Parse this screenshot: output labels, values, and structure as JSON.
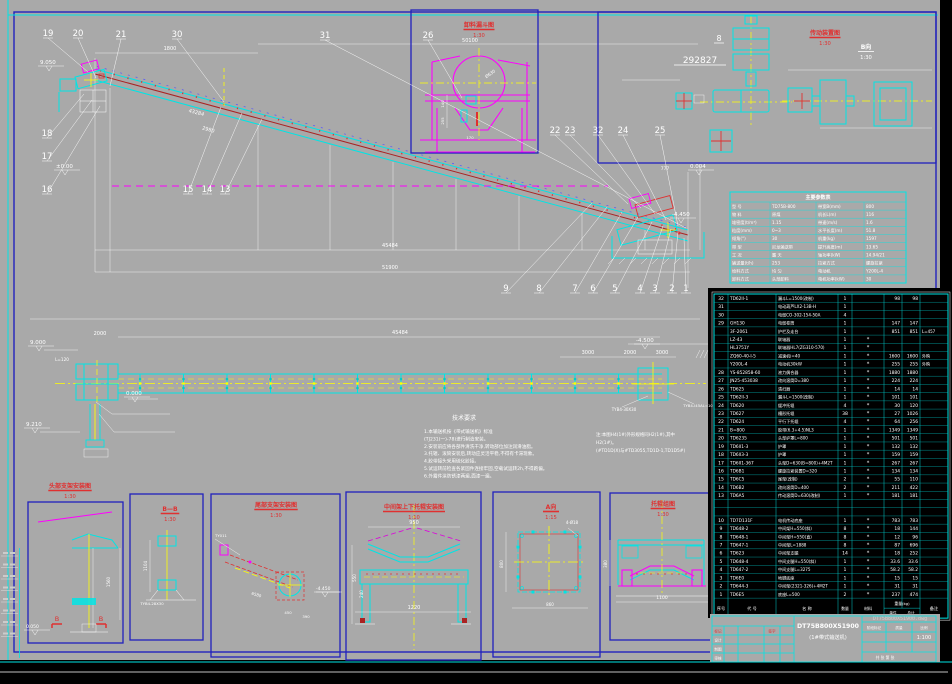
{
  "drawing": {
    "title": "DT75B800X51900",
    "subtitle": "(1#带式输送机)",
    "scale": "1:100",
    "watermark": "DT75B800X51900.dwg",
    "sheet_note": "共 张 第 张",
    "stage_labels": [
      "阶段标记",
      "质量",
      "比例"
    ],
    "revision_header": [
      "标记",
      "签字"
    ],
    "revision_rows": [
      "设计",
      "制图",
      "审核"
    ]
  },
  "colors": {
    "paper": "#a9a9a9",
    "frame": "#2121bd",
    "cyan": "#00e5e5",
    "magenta": "#ff00ff",
    "yellow": "#ffff00",
    "red": "#e03030",
    "dark_red": "#aa2222",
    "white": "#ffffff",
    "black": "#000000"
  },
  "view_titles": [
    {
      "label": "卸料漏斗图",
      "scale": "1:30",
      "x": 479,
      "y": 27,
      "color": "red"
    },
    {
      "label": "传动装置图",
      "scale": "1:30",
      "x": 825,
      "y": 35,
      "color": "red"
    },
    {
      "label": "B向",
      "scale": "1:30",
      "x": 866,
      "y": 49,
      "color": "white"
    },
    {
      "label": "头部支架安装图",
      "scale": "1:30",
      "x": 70,
      "y": 488,
      "color": "red"
    },
    {
      "label": "B—B",
      "scale": "1:30",
      "x": 170,
      "y": 511,
      "color": "red"
    },
    {
      "label": "尾部支架安装图",
      "scale": "1:30",
      "x": 276,
      "y": 507,
      "color": "red"
    },
    {
      "label": "中间架上下托辊安装图",
      "scale": "1:10",
      "x": 414,
      "y": 509,
      "color": "red"
    },
    {
      "label": "A向",
      "scale": "1:15",
      "x": 551,
      "y": 509,
      "color": "red"
    },
    {
      "label": "托辊组图",
      "scale": "1:30",
      "x": 663,
      "y": 506,
      "color": "red"
    }
  ],
  "balloons": [
    {
      "n": "19",
      "x": 48,
      "y": 36,
      "lx": 88,
      "ly": 72
    },
    {
      "n": "20",
      "x": 78,
      "y": 36,
      "lx": 96,
      "ly": 78
    },
    {
      "n": "21",
      "x": 121,
      "y": 37,
      "lx": 110,
      "ly": 86
    },
    {
      "n": "30",
      "x": 177,
      "y": 37,
      "lx": 224,
      "ly": 102
    },
    {
      "n": "31",
      "x": 325,
      "y": 38,
      "lx": 686,
      "ly": 228
    },
    {
      "n": "26",
      "x": 428,
      "y": 38,
      "lx": 462,
      "ly": 98
    },
    {
      "n": "22",
      "x": 555,
      "y": 133,
      "lx": 628,
      "ly": 204
    },
    {
      "n": "23",
      "x": 570,
      "y": 133,
      "lx": 641,
      "ly": 208
    },
    {
      "n": "32",
      "x": 598,
      "y": 133,
      "lx": 655,
      "ly": 214
    },
    {
      "n": "24",
      "x": 623,
      "y": 133,
      "lx": 666,
      "ly": 220
    },
    {
      "n": "25",
      "x": 660,
      "y": 133,
      "lx": 678,
      "ly": 226
    },
    {
      "n": "18",
      "x": 47,
      "y": 136,
      "lx": 84,
      "ly": 94
    },
    {
      "n": "17",
      "x": 47,
      "y": 159,
      "lx": 92,
      "ly": 100
    },
    {
      "n": "16",
      "x": 47,
      "y": 192,
      "lx": 100,
      "ly": 106
    },
    {
      "n": "15",
      "x": 188,
      "y": 192,
      "lx": 221,
      "ly": 107
    },
    {
      "n": "14",
      "x": 207,
      "y": 192,
      "lx": 242,
      "ly": 113
    },
    {
      "n": "13",
      "x": 225,
      "y": 192,
      "lx": 262,
      "ly": 119
    },
    {
      "n": "9",
      "x": 506,
      "y": 291,
      "lx": 592,
      "ly": 203
    },
    {
      "n": "8",
      "x": 539,
      "y": 291,
      "lx": 607,
      "ly": 207
    },
    {
      "n": "7",
      "x": 575,
      "y": 291,
      "lx": 622,
      "ly": 212
    },
    {
      "n": "6",
      "x": 593,
      "y": 291,
      "lx": 638,
      "ly": 217
    },
    {
      "n": "5",
      "x": 615,
      "y": 291,
      "lx": 652,
      "ly": 222
    },
    {
      "n": "4",
      "x": 640,
      "y": 291,
      "lx": 663,
      "ly": 226
    },
    {
      "n": "3",
      "x": 655,
      "y": 291,
      "lx": 671,
      "ly": 229
    },
    {
      "n": "2",
      "x": 672,
      "y": 291,
      "lx": 678,
      "ly": 232
    },
    {
      "n": "1",
      "x": 686,
      "y": 291,
      "lx": 684,
      "ly": 238
    }
  ],
  "elevations": [
    {
      "v": "9.050",
      "x": 40,
      "y": 64
    },
    {
      "v": "±0.00",
      "x": 56,
      "y": 168
    },
    {
      "v": "0.004",
      "x": 690,
      "y": 168
    },
    {
      "v": "-4.450",
      "x": 672,
      "y": 216
    },
    {
      "v": "9.000",
      "x": 30,
      "y": 344
    },
    {
      "v": "9.210",
      "x": 26,
      "y": 426
    },
    {
      "v": "0.000",
      "x": 126,
      "y": 395
    },
    {
      "v": "-4.500",
      "x": 636,
      "y": 342
    },
    {
      "v": "0.050",
      "x": 26,
      "y": 628,
      "s": 4.5
    },
    {
      "v": "-4.450",
      "x": 316,
      "y": 590,
      "s": 4.5
    }
  ],
  "dimensions": [
    {
      "v": "1800",
      "x": 170,
      "y": 50
    },
    {
      "v": "50100",
      "x": 470,
      "y": 42
    },
    {
      "v": "43284",
      "x": 196,
      "y": 114,
      "rot": 15
    },
    {
      "v": "2980",
      "x": 208,
      "y": 131,
      "rot": 15
    },
    {
      "v": "45484",
      "x": 390,
      "y": 247
    },
    {
      "v": "51900",
      "x": 390,
      "y": 269
    },
    {
      "v": "777",
      "x": 665,
      "y": 170,
      "s": 4.5
    },
    {
      "v": "45484",
      "x": 400,
      "y": 334
    },
    {
      "v": "2000",
      "x": 100,
      "y": 335
    },
    {
      "v": "3000",
      "x": 588,
      "y": 354
    },
    {
      "v": "2000",
      "x": 630,
      "y": 354
    },
    {
      "v": "3000",
      "x": 662,
      "y": 354
    },
    {
      "v": "1220",
      "x": 414,
      "y": 609
    },
    {
      "v": "950",
      "x": 414,
      "y": 524
    },
    {
      "v": "550",
      "x": 356,
      "y": 578,
      "rot": -90,
      "s": 4
    },
    {
      "v": "240",
      "x": 363,
      "y": 594,
      "rot": -90,
      "s": 4
    },
    {
      "v": "1560",
      "x": 110,
      "y": 582,
      "rot": -90,
      "s": 4
    },
    {
      "v": "1104",
      "x": 147,
      "y": 566,
      "rot": -90,
      "s": 4
    },
    {
      "v": "6580",
      "x": 256,
      "y": 596,
      "rot": 17,
      "s": 4
    },
    {
      "v": "450",
      "x": 288,
      "y": 614,
      "s": 3.8
    },
    {
      "v": "390",
      "x": 306,
      "y": 618,
      "s": 3.8
    },
    {
      "v": "860",
      "x": 550,
      "y": 606,
      "s": 4
    },
    {
      "v": "800",
      "x": 503,
      "y": 564,
      "rot": -90,
      "s": 4
    },
    {
      "v": "1100",
      "x": 662,
      "y": 599,
      "s": 4.5
    },
    {
      "v": "380",
      "x": 607,
      "y": 564,
      "rot": -90,
      "s": 4
    },
    {
      "v": "170",
      "x": 470,
      "y": 139,
      "s": 3.8
    },
    {
      "v": "140",
      "x": 444,
      "y": 104,
      "rot": -90,
      "s": 3.8
    },
    {
      "v": "255",
      "x": 444,
      "y": 121,
      "rot": -90,
      "s": 3.8
    },
    {
      "v": "Ø630",
      "x": 491,
      "y": 75,
      "rot": -35,
      "s": 4.2
    },
    {
      "v": "4-Ø18",
      "x": 572,
      "y": 524,
      "s": 4
    }
  ],
  "labels": [
    {
      "v": "292827",
      "x": 700,
      "y": 63,
      "s": 9,
      "u": 26
    },
    {
      "v": "8",
      "x": 719,
      "y": 41,
      "s": 8,
      "u": 5
    },
    {
      "v": "TYB4-30X30",
      "x": 624,
      "y": 411,
      "s": 4
    },
    {
      "v": "TYB4-I45AL=10",
      "x": 698,
      "y": 407,
      "s": 3.8
    },
    {
      "v": "TYB4-28X30",
      "x": 152,
      "y": 605,
      "s": 3.8
    },
    {
      "v": "TY011",
      "x": 221,
      "y": 537,
      "s": 3.8
    },
    {
      "v": "L=120",
      "x": 62,
      "y": 361,
      "s": 4.2
    },
    {
      "v": "B",
      "x": 57,
      "y": 621,
      "s": 6.5,
      "c": "#e03030"
    },
    {
      "v": "B",
      "x": 101,
      "y": 621,
      "s": 6.5,
      "c": "#e03030"
    }
  ],
  "notes": {
    "title": "技术要求",
    "lines": [
      "1.本输送机按《带式输送机》标准",
      "  (TJ231(一)-78)进行制造安装。",
      "2.安装前应将各部件清洗干净,转动部位加注润滑油脂。",
      "3.托辊、滚筒安装后,转动应灵活平稳,不得有卡滞现象。",
      "4.胶带接头采用硫化胶接。",
      "5.试运转前检查各紧固件连接牢固,空载试运转2h,不得跑偏。",
      "6.外露件涂防锈漆两遍,面漆一遍。"
    ]
  },
  "side_note": {
    "lines": [
      "注:本图H4(1#)外形规格同H2(1#),其中",
      "   H2(1#)。",
      "(#TD1D(X)与#TD3055,TD1D-1,TD1D5#)"
    ]
  },
  "param_table": {
    "title": "主要参数表",
    "rows": [
      [
        "型 号",
        "TD75B-800",
        "带宽B(mm)",
        "800"
      ],
      [
        "物 料",
        "原煤",
        "机长L(m)",
        "116"
      ],
      [
        "堆密度(t/m³)",
        "1.15",
        "带速(m/s)",
        "1.6"
      ],
      [
        "粒度(mm)",
        "0~3",
        "水平长度(m)",
        "51.8"
      ],
      [
        "倾角(°)",
        "30",
        "机重(kg)",
        "1597"
      ],
      [
        "带 型",
        "尼龙输送带",
        "提升高度(m)",
        "13.65"
      ],
      [
        "工 况",
        "露 天",
        "轴功率(kW)",
        "14.94/21"
      ],
      [
        "输送量(t/h)",
        "253",
        "拉紧方式",
        "螺旋拉紧"
      ],
      [
        "给料方式",
        "均 匀",
        "电动机",
        "Y200L-4"
      ],
      [
        "卸料方式",
        "头部卸料",
        "电机功率(kW)",
        "30"
      ]
    ]
  },
  "bom": {
    "headers": [
      "序号",
      "代  号",
      "名    称",
      "数量",
      "材料",
      "重量(kg)",
      "单件",
      "总计",
      "备注"
    ],
    "rows": [
      [
        "32",
        "TD62II-1",
        "漏斗L=1500(改制)",
        "1",
        "",
        "98",
        "98",
        ""
      ],
      [
        "31",
        "",
        "电动葫芦LX2-13B-H",
        "1",
        "",
        "",
        "",
        ""
      ],
      [
        "30",
        "",
        "电缆CO-302-154-50A",
        "4",
        "",
        "",
        "",
        ""
      ],
      [
        "29",
        "GH130",
        "电缆卷筒",
        "1",
        "",
        "147",
        "147",
        ""
      ],
      [
        "",
        "3F-2061",
        "护栏及走台",
        "1",
        "",
        "851",
        "851",
        "L=457"
      ],
      [
        "",
        "LZ-43",
        "联轴器",
        "1",
        "*",
        "",
        "",
        ""
      ],
      [
        "",
        "HL3751Y",
        "联轴器HL7(ZG310-570)",
        "1",
        "*",
        "",
        "",
        ""
      ],
      [
        "",
        "ZQ60-40-I-5",
        "减速机i=40",
        "1",
        "*",
        "1600",
        "1600",
        "外购"
      ],
      [
        "",
        "Y200L-4",
        "电动机30kW",
        "1",
        "*",
        "255",
        "255",
        "外购"
      ],
      [
        "28",
        "YS-852858-60",
        "液力偶合器",
        "1",
        "*",
        "1880",
        "1880",
        ""
      ],
      [
        "27",
        "JN25-453038",
        "改向滚筒D=380",
        "1",
        "*",
        "224",
        "224",
        ""
      ],
      [
        "26",
        "TD625",
        "清扫器",
        "1",
        "*",
        "14",
        "14",
        ""
      ],
      [
        "25",
        "TD62II-3",
        "漏斗L=1500(改制)",
        "1",
        "*",
        "101",
        "101",
        ""
      ],
      [
        "24",
        "TD620",
        "缓冲托辊",
        "4",
        "*",
        "30",
        "120",
        ""
      ],
      [
        "23",
        "TD627",
        "槽形托辊",
        "38",
        "*",
        "27",
        "1026",
        ""
      ],
      [
        "22",
        "TD624",
        "平行下托辊",
        "4",
        "*",
        "64",
        "256",
        ""
      ],
      [
        "21",
        "B=800",
        "胶带(6.3+4.5)NL3",
        "1",
        "*",
        "1349",
        "1349",
        ""
      ],
      [
        "20",
        "TD6235",
        "头部护罩L=800",
        "1",
        "*",
        "501",
        "501",
        ""
      ],
      [
        "19",
        "TD6II1-3",
        "护罩",
        "1",
        "*",
        "132",
        "132",
        ""
      ],
      [
        "18",
        "TD6II3-3",
        "护罩",
        "1",
        "*",
        "159",
        "159",
        ""
      ],
      [
        "17",
        "TD6II1-367",
        "头架D=630(B=800)+4M2T",
        "1",
        "*",
        "267",
        "267",
        ""
      ],
      [
        "16",
        "TD6B1",
        "螺旋拉紧装置D=320",
        "1",
        "*",
        "134",
        "134",
        ""
      ],
      [
        "15",
        "TD6C5",
        "尾架(改制)",
        "2",
        "*",
        "55",
        "110",
        ""
      ],
      [
        "14",
        "TD6B2",
        "改向滚筒D=400",
        "2",
        "*",
        "211",
        "422",
        ""
      ],
      [
        "13",
        "TD6A5",
        "传动滚筒D=630(改制)",
        "1",
        "*",
        "181",
        "181",
        ""
      ],
      [
        "",
        "",
        "",
        "",
        "",
        "",
        "",
        ""
      ],
      [
        "",
        "",
        "",
        "",
        "",
        "",
        "",
        ""
      ],
      [
        "10",
        "TD7D131F",
        "电机传动底座",
        "1",
        "*",
        "783",
        "783",
        ""
      ],
      [
        "9",
        "TD648-2",
        "中间架H=550(斜)",
        "8",
        "*",
        "18",
        "144",
        ""
      ],
      [
        "8",
        "TD648-1",
        "中间架H=550(直)",
        "8",
        "*",
        "12",
        "96",
        ""
      ],
      [
        "7",
        "TD647-1",
        "中间架L=1888",
        "8",
        "*",
        "87",
        "696",
        ""
      ],
      [
        "6",
        "TD623",
        "中间架支腿",
        "14",
        "*",
        "18",
        "252",
        ""
      ],
      [
        "5",
        "TD648-4",
        "中间支腿H=550(斜)",
        "1",
        "*",
        "33.6",
        "33.6",
        ""
      ],
      [
        "4",
        "TD647-2",
        "中间支腿L=3275",
        "1",
        "*",
        "58.2",
        "58.2",
        ""
      ],
      [
        "3",
        "TD6E0",
        "地脚底座",
        "1",
        "*",
        "15",
        "15",
        ""
      ],
      [
        "2",
        "TD644-3",
        "中间架(2321-326)+4M2T",
        "1",
        "*",
        "31",
        "31",
        ""
      ],
      [
        "1",
        "TD6E5",
        "底座L=500",
        "2",
        "*",
        "237",
        "474",
        ""
      ]
    ]
  }
}
